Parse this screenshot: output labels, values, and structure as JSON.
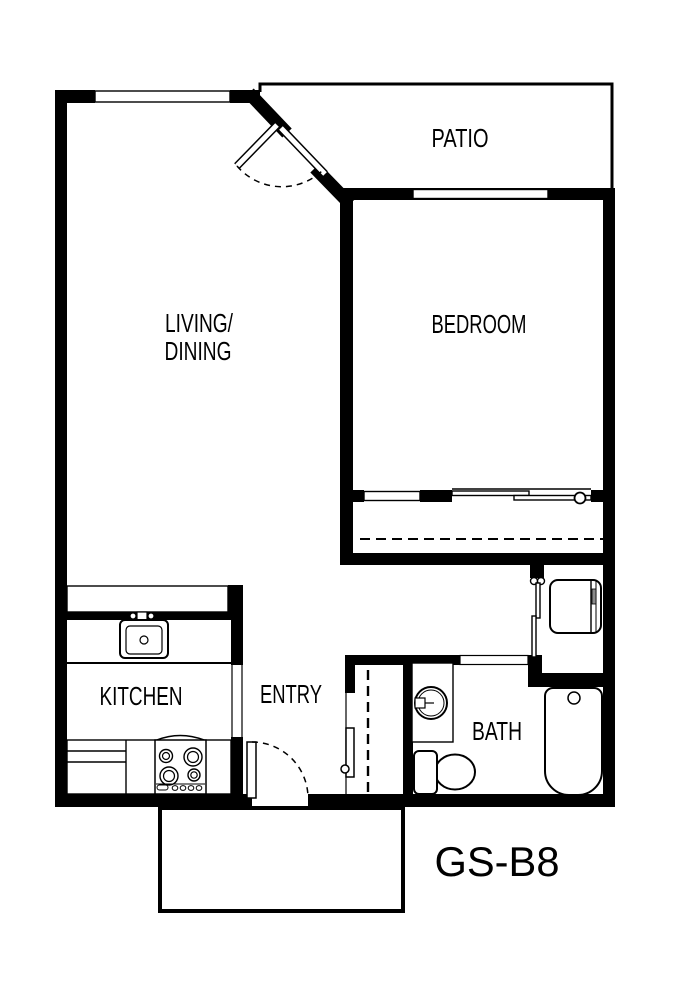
{
  "title": "GS-B8",
  "rooms": {
    "patio": "PATIO",
    "bedroom": "BEDROOM",
    "living_dining_line1": "LIVING/",
    "living_dining_line2": "DINING",
    "kitchen": "KITCHEN",
    "entry": "ENTRY",
    "bath": "BATH"
  },
  "colors": {
    "wall": "#000000",
    "floor": "#ffffff",
    "cabinet_handle": "#8a8a8a"
  }
}
